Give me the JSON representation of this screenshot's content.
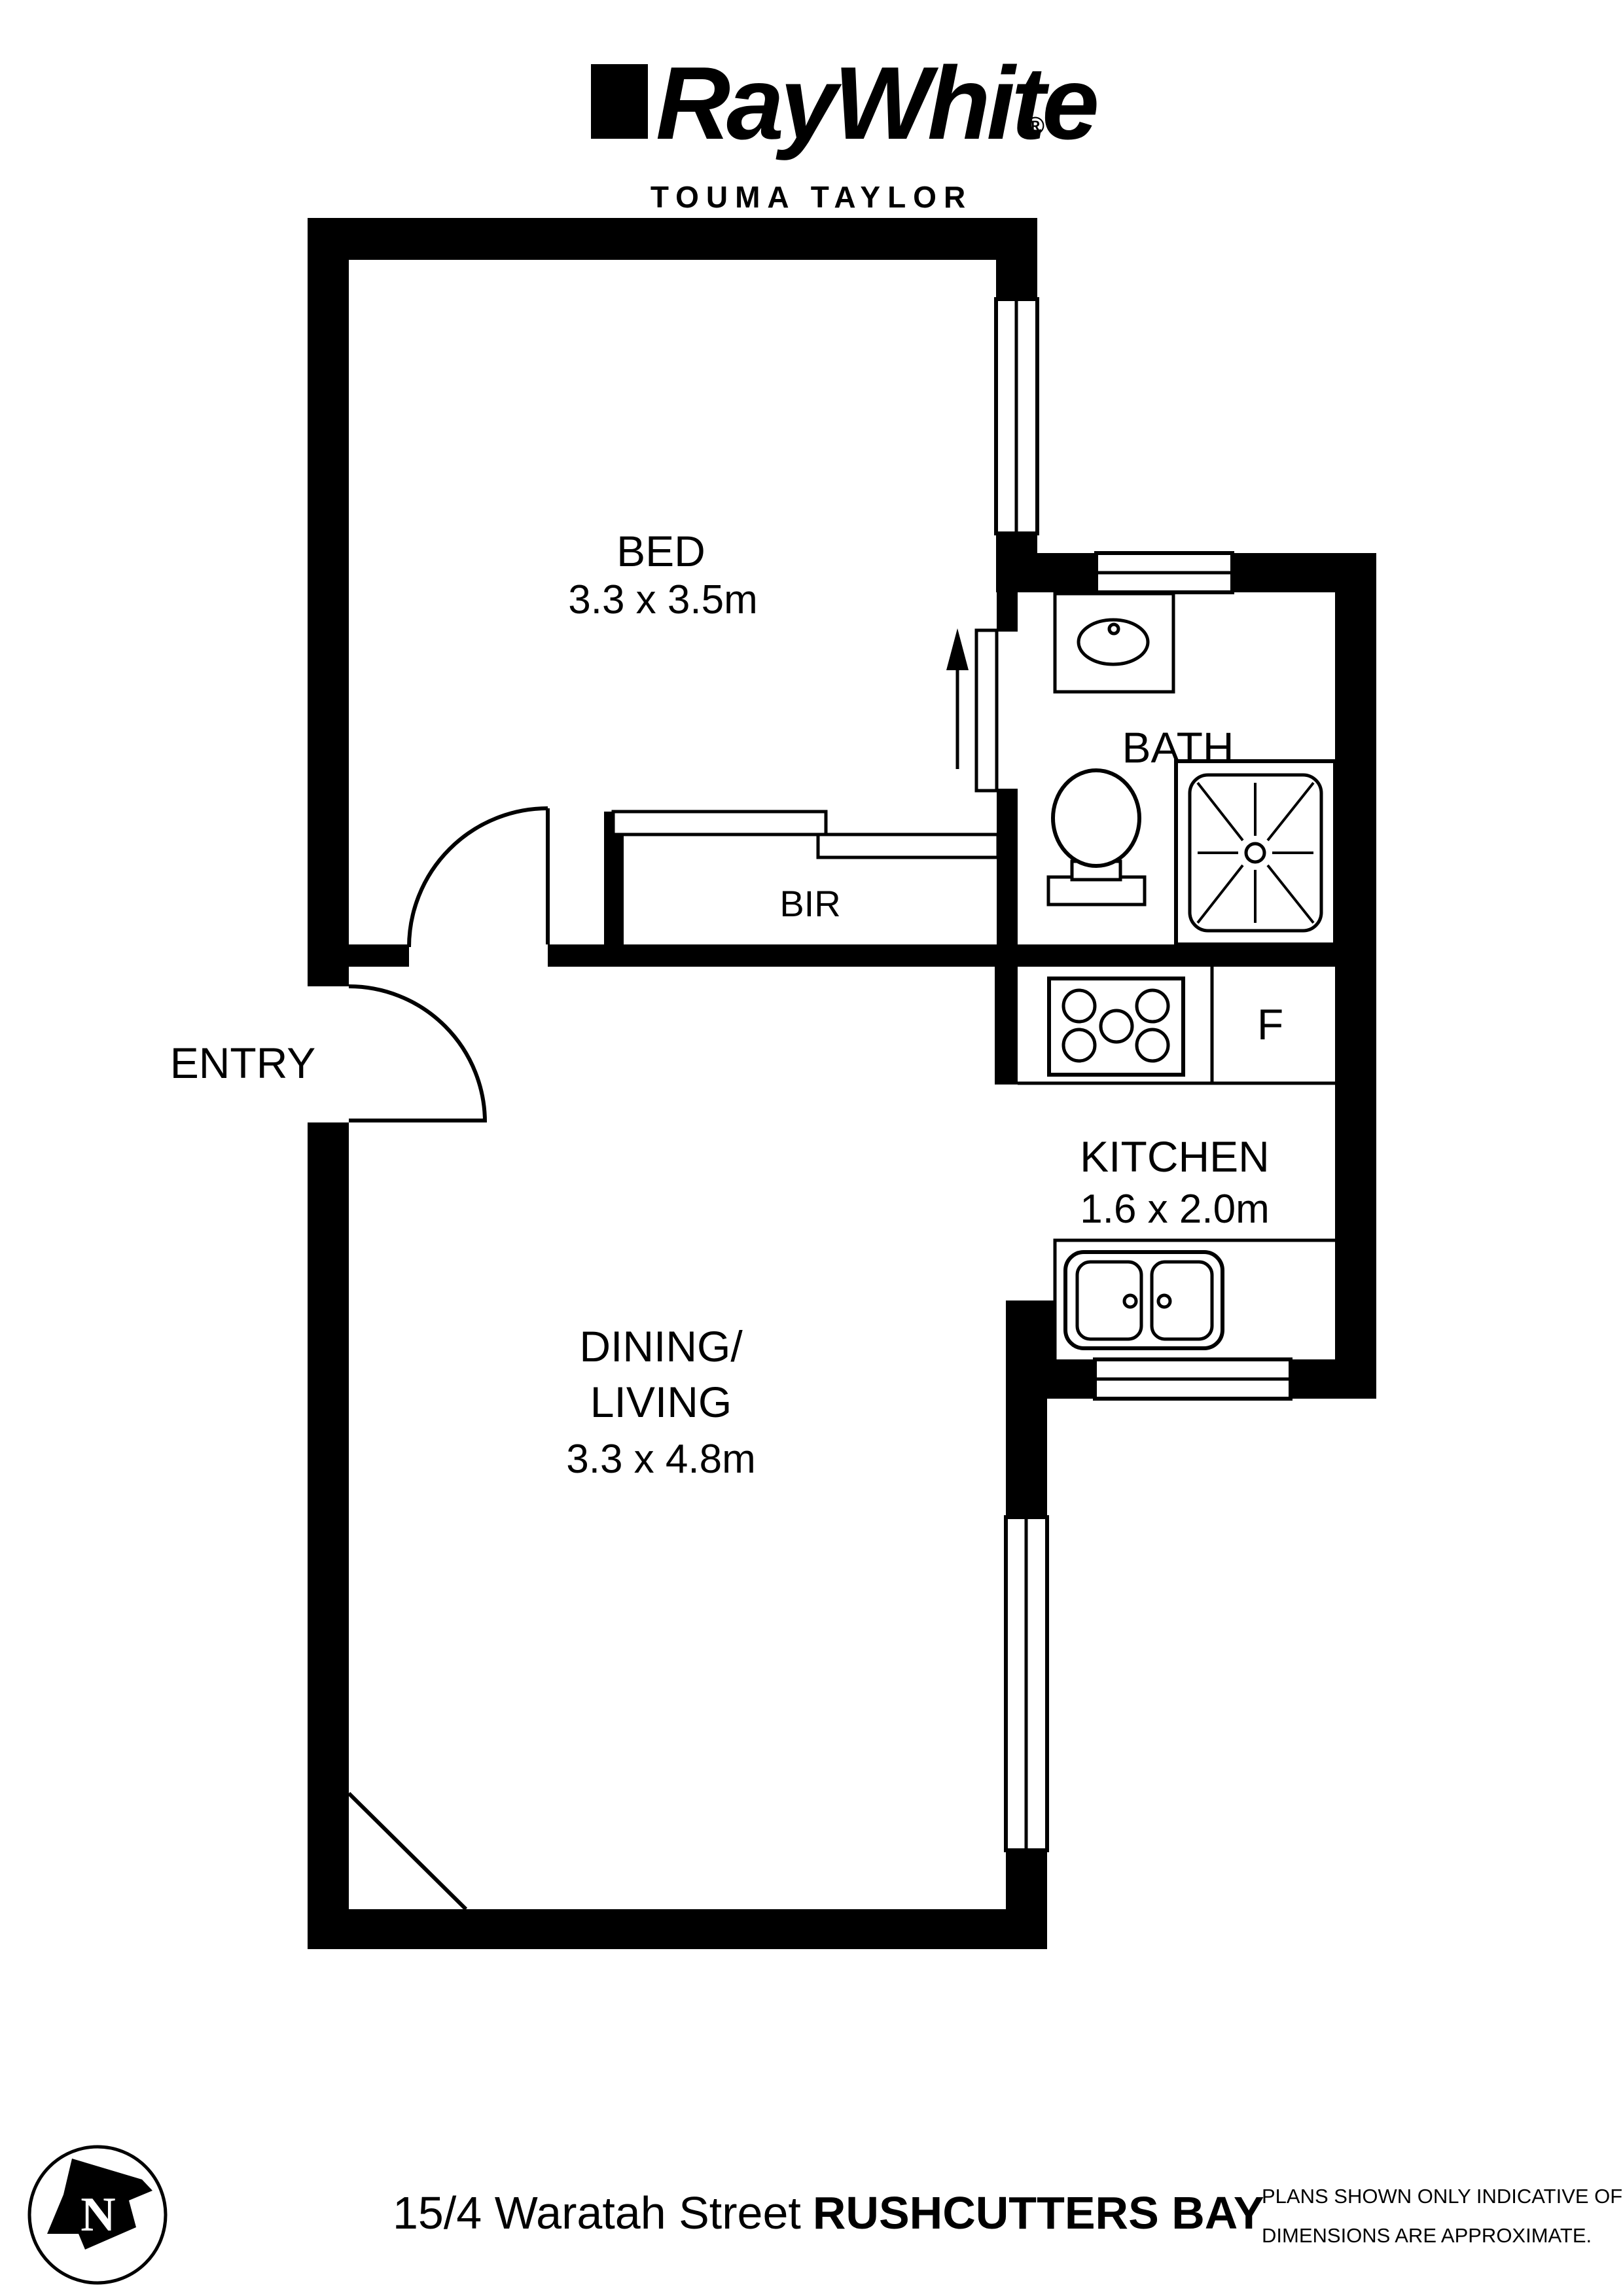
{
  "header": {
    "brand": "RayWhite",
    "registered": "®",
    "office": "TOUMA TAYLOR"
  },
  "plan": {
    "bed": {
      "label": "BED",
      "dims": "3.3 x 3.5m"
    },
    "bath": {
      "label": "BATH"
    },
    "bir": {
      "label": "BIR"
    },
    "entry": {
      "label": "ENTRY"
    },
    "kitchen": {
      "label": "KITCHEN",
      "dims": "1.6 x 2.0m"
    },
    "fridge": {
      "label": "F"
    },
    "dining": {
      "label_line1": "DINING/",
      "label_line2": "LIVING",
      "dims": "3.3 x 4.8m"
    }
  },
  "compass": {
    "label": "N"
  },
  "footer": {
    "address_street": "15/4 Waratah Street",
    "address_suburb": "RUSHCUTTERS BAY",
    "disclaimer_line1": "PLANS SHOWN ONLY INDICATIVE OF LAYOUT.",
    "disclaimer_line2": "DIMENSIONS ARE APPROXIMATE."
  },
  "colors": {
    "ink": "#000000",
    "paper": "#ffffff"
  }
}
